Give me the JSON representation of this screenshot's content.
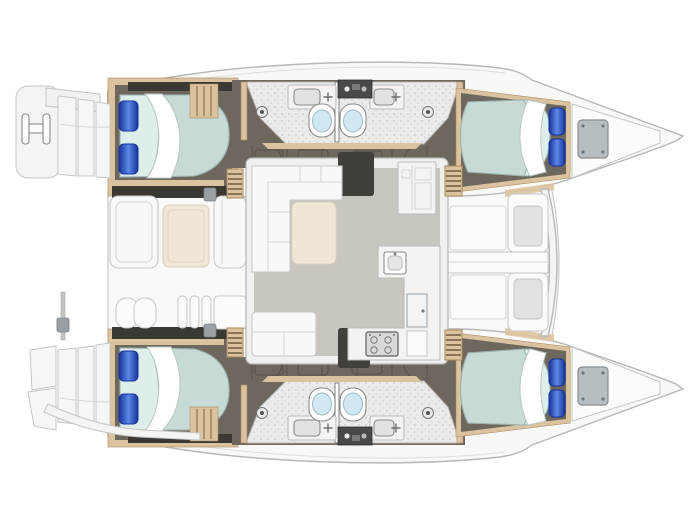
{
  "meta": {
    "title": "Catamaran yacht layout plan",
    "view": "top-down deck and accommodation plan",
    "orientation": "bows pointing right, twin hulls joined by bridge deck"
  },
  "counts": {
    "cabins": 4,
    "double_berths": 4,
    "toilets": 4,
    "sinks": 4,
    "showers": 4,
    "companionway_steps": 4
  },
  "parts": {
    "port_hull": [
      "aft-double-berth",
      "blue-pillow",
      "blue-pillow",
      "hanging-locker",
      "aft-head-toilet-sink-shower",
      "forward-head-toilet-sink-shower",
      "forward-double-berth",
      "bow-locker-hatch"
    ],
    "starboard_hull": [
      "aft-double-berth",
      "blue-pillow",
      "blue-pillow",
      "hanging-locker",
      "aft-head-toilet-sink-shower",
      "forward-head-toilet-sink-shower",
      "forward-double-berth",
      "bow-locker-hatch"
    ],
    "saloon": [
      "l-shaped-sofa",
      "chaise-cushion",
      "aft-bench",
      "galley-counter",
      "galley-sink",
      "stove-four-burner",
      "fridge-door",
      "forward-cabinet",
      "entry-alcove-port",
      "entry-alcove-starboard"
    ],
    "cockpit": [
      "bench-seat",
      "cockpit-table",
      "bench-seat",
      "twin-helm-seat",
      "transom-louvers",
      "transom-panel"
    ],
    "foredeck": [
      "deck-panel",
      "deck-panel",
      "sun-pad-port",
      "sun-pad-starboard",
      "center-walkway",
      "forward-crossbeam"
    ],
    "sterns": [
      "port-platform-with-boarding-ladder",
      "port-transom-steps",
      "starboard-transom-steps",
      "starboard-curved-swim-platform",
      "davit-pole"
    ]
  },
  "colors": {
    "hull_fill": "#f8f8f6",
    "hull_stroke": "#b7b8b6",
    "deck_fill": "#f9f9f8",
    "deck_stroke": "#c9c9c7",
    "panel_fill": "#fbfbfa",
    "panel_stroke": "#c6c6c4",
    "wood": "#dcc3a0",
    "wood_dark": "#a8895f",
    "step_rung": "#6f5b3e",
    "floor_dark": "#6e675e",
    "floor_line": "#57514a",
    "canopy_dark": "#3b3833",
    "bath_floor": "#ebebe9",
    "bath_stroke": "#b0b0ae",
    "speckle": "#c4c4c2",
    "porcelain": "#ffffff",
    "fixture_stroke": "#8a8a88",
    "bowl": "#cfe8f2",
    "mattress": "#c7dad6",
    "mattress_edge": "#9cb4b0",
    "sheet": "#ddeeeb",
    "duvet": "#ffffff",
    "pillow_dark": "#15339b",
    "pillow_light": "#5d88e6",
    "saloon_floor": "#c9c6c0",
    "sofa": "#f8f8f7",
    "sofa_stroke": "#c8c8c6",
    "cushion_cream": "#efe7d5",
    "counter": "#f4f3f1",
    "counter_stroke": "#bcbcba",
    "alcove_dark": "#423f3a",
    "appliance_dark": "#4a4946",
    "stove": "#d9d9d7",
    "hatch_gray": "#b7bec2",
    "pad_gray": "#e0e2e0",
    "latch_gray": "#9aa0a4"
  }
}
